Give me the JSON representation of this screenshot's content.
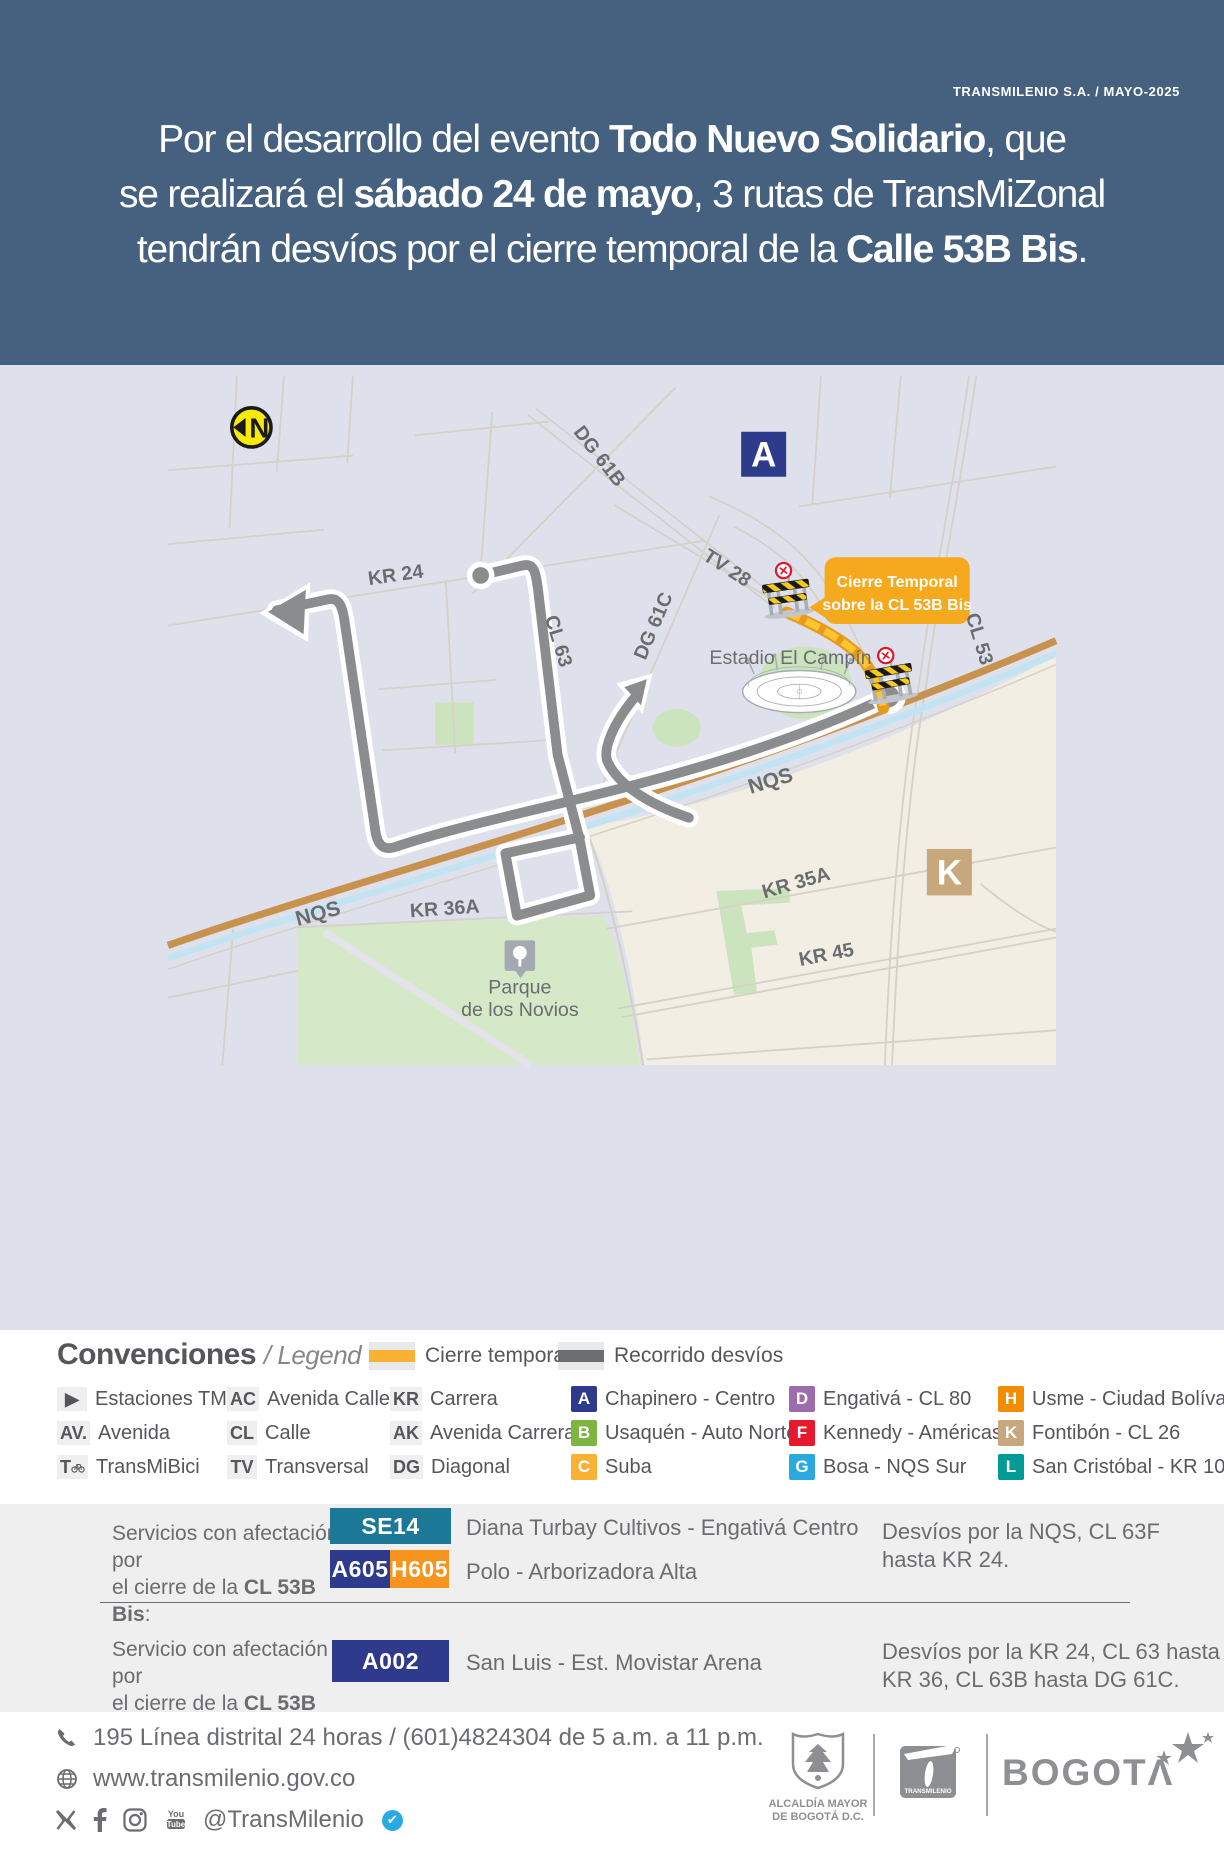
{
  "header": {
    "credit": "TRANSMILENIO S.A. / MAYO-2025",
    "title_lines": [
      [
        {
          "t": "Por el desarrollo del evento "
        },
        {
          "t": "Todo Nuevo Solidario",
          "b": 1
        },
        {
          "t": ", que"
        }
      ],
      [
        {
          "t": "se realizará el "
        },
        {
          "t": "sábado 24 de mayo",
          "b": 1
        },
        {
          "t": ", 3 rutas de TransMiZonal"
        }
      ],
      [
        {
          "t": "tendrán desvíos por el cierre temporal de la "
        },
        {
          "t": "Calle 53B Bis",
          "b": 1
        },
        {
          "t": "."
        }
      ]
    ]
  },
  "map": {
    "compass": "N",
    "markers": {
      "a": "A",
      "k": "K"
    },
    "callout": {
      "line1": "Cierre Temporal",
      "line2": "sobre la CL 53B Bis"
    },
    "street_labels": [
      {
        "text": "DG 61B"
      },
      {
        "text": "KR 24"
      },
      {
        "text": "TV 28"
      },
      {
        "text": "DG 61C"
      },
      {
        "text": "CL 63"
      },
      {
        "text": "CL 53"
      },
      {
        "text": "NQS"
      },
      {
        "text": "NQS"
      },
      {
        "text": "KR 35A"
      },
      {
        "text": "KR 45"
      },
      {
        "text": "KR 36A"
      }
    ],
    "places": {
      "stadium": "Estadio El Campín",
      "park_line1": "Parque",
      "park_line2": "de los Novios"
    }
  },
  "legend": {
    "title": "Convenciones",
    "subtitle": "/ Legend",
    "swatches": [
      {
        "label": "Cierre temporal",
        "color": "#F9B233"
      },
      {
        "label": "Recorrido desvíos",
        "color": "#6D6E71"
      }
    ],
    "abbr_col1": [
      {
        "abbr": "▶",
        "label": "Estaciones TM"
      },
      {
        "abbr": "AV.",
        "label": "Avenida"
      },
      {
        "abbr": "T",
        "label": "TransMiBici"
      }
    ],
    "abbr_col2": [
      {
        "abbr": "AC",
        "label": "Avenida Calle"
      },
      {
        "abbr": "CL",
        "label": "Calle"
      },
      {
        "abbr": "TV",
        "label": "Transversal"
      }
    ],
    "abbr_col3": [
      {
        "abbr": "KR",
        "label": "Carrera"
      },
      {
        "abbr": "AK",
        "label": "Avenida Carrera"
      },
      {
        "abbr": "DG",
        "label": "Diagonal"
      }
    ],
    "zones": [
      {
        "letter": "A",
        "color": "#2E3A8C",
        "label": "Chapinero - Centro"
      },
      {
        "letter": "B",
        "color": "#7DB442",
        "label": "Usaquén - Auto Norte"
      },
      {
        "letter": "C",
        "color": "#F9B233",
        "label": "Suba"
      },
      {
        "letter": "D",
        "color": "#9C6CAD",
        "label": "Engativá - CL 80"
      },
      {
        "letter": "F",
        "color": "#E8182D",
        "label": "Kennedy - Américas"
      },
      {
        "letter": "G",
        "color": "#29A9E0",
        "label": "Bosa - NQS Sur"
      },
      {
        "letter": "H",
        "color": "#F28C00",
        "label": "Usme - Ciudad Bolívar"
      },
      {
        "letter": "K",
        "color": "#C7A87D",
        "label": "Fontibón - CL 26"
      },
      {
        "letter": "L",
        "color": "#009B94",
        "label": "San Cristóbal - KR 10"
      }
    ]
  },
  "services": {
    "row1": {
      "label_line1": "Servicios con afectación por",
      "label_line2": [
        {
          "t": "el cierre de la "
        },
        {
          "t": "CL 53B Bis",
          "b": 1
        },
        {
          "t": ":"
        }
      ],
      "badge1": {
        "code": "SE14",
        "color": "#1B7897"
      },
      "badge2a": {
        "code": "A605",
        "color": "#2E3A8C"
      },
      "badge2b": {
        "code": "H605",
        "color": "#F7941D"
      },
      "route1": "Diana Turbay Cultivos - Engativá Centro",
      "route2": "Polo - Arborizadora Alta",
      "note_line1": "Desvíos por la NQS, CL 63F",
      "note_line2": "hasta KR 24."
    },
    "row2": {
      "label_line1": "Servicio con afectación por",
      "label_line2": [
        {
          "t": "el cierre de la "
        },
        {
          "t": "CL 53B Bis",
          "b": 1
        },
        {
          "t": ":"
        }
      ],
      "badge1": {
        "code": "A002",
        "color": "#2E3A8C"
      },
      "route1": "San Luis - Est. Movistar Arena",
      "note_line1": "Desvíos por la KR 24, CL 63 hasta",
      "note_line2": "KR 36, CL 63B hasta DG 61C."
    }
  },
  "footer": {
    "phone": "195 Línea distrital 24 horas / (601)4824304 de 5 a.m. a 11 p.m.",
    "web": "www.transmilenio.gov.co",
    "social_handle": "@TransMilenio",
    "verified_check": "✔",
    "alcaldia_line1": "ALCALDÍA MAYOR",
    "alcaldia_line2": "DE BOGOTÁ D.C.",
    "transmilenio_label": "TRANSMILENIO",
    "bogota_word": "BOGOTΛ"
  },
  "colors": {
    "header_bg": "#45617F",
    "map_bg": "#DEE1EC",
    "map_beige": "#F2EEE3",
    "park_green": "#D5E9C8",
    "nqs_tan": "#C8924E",
    "canal_blue": "#C2E4F2",
    "route_gray": "#8A8C8E",
    "closure_yellow": "#E79B1E",
    "closure_dash": "#FFC52E",
    "callout_orange": "#F5A91D",
    "compass_yellow": "#F8E908"
  }
}
